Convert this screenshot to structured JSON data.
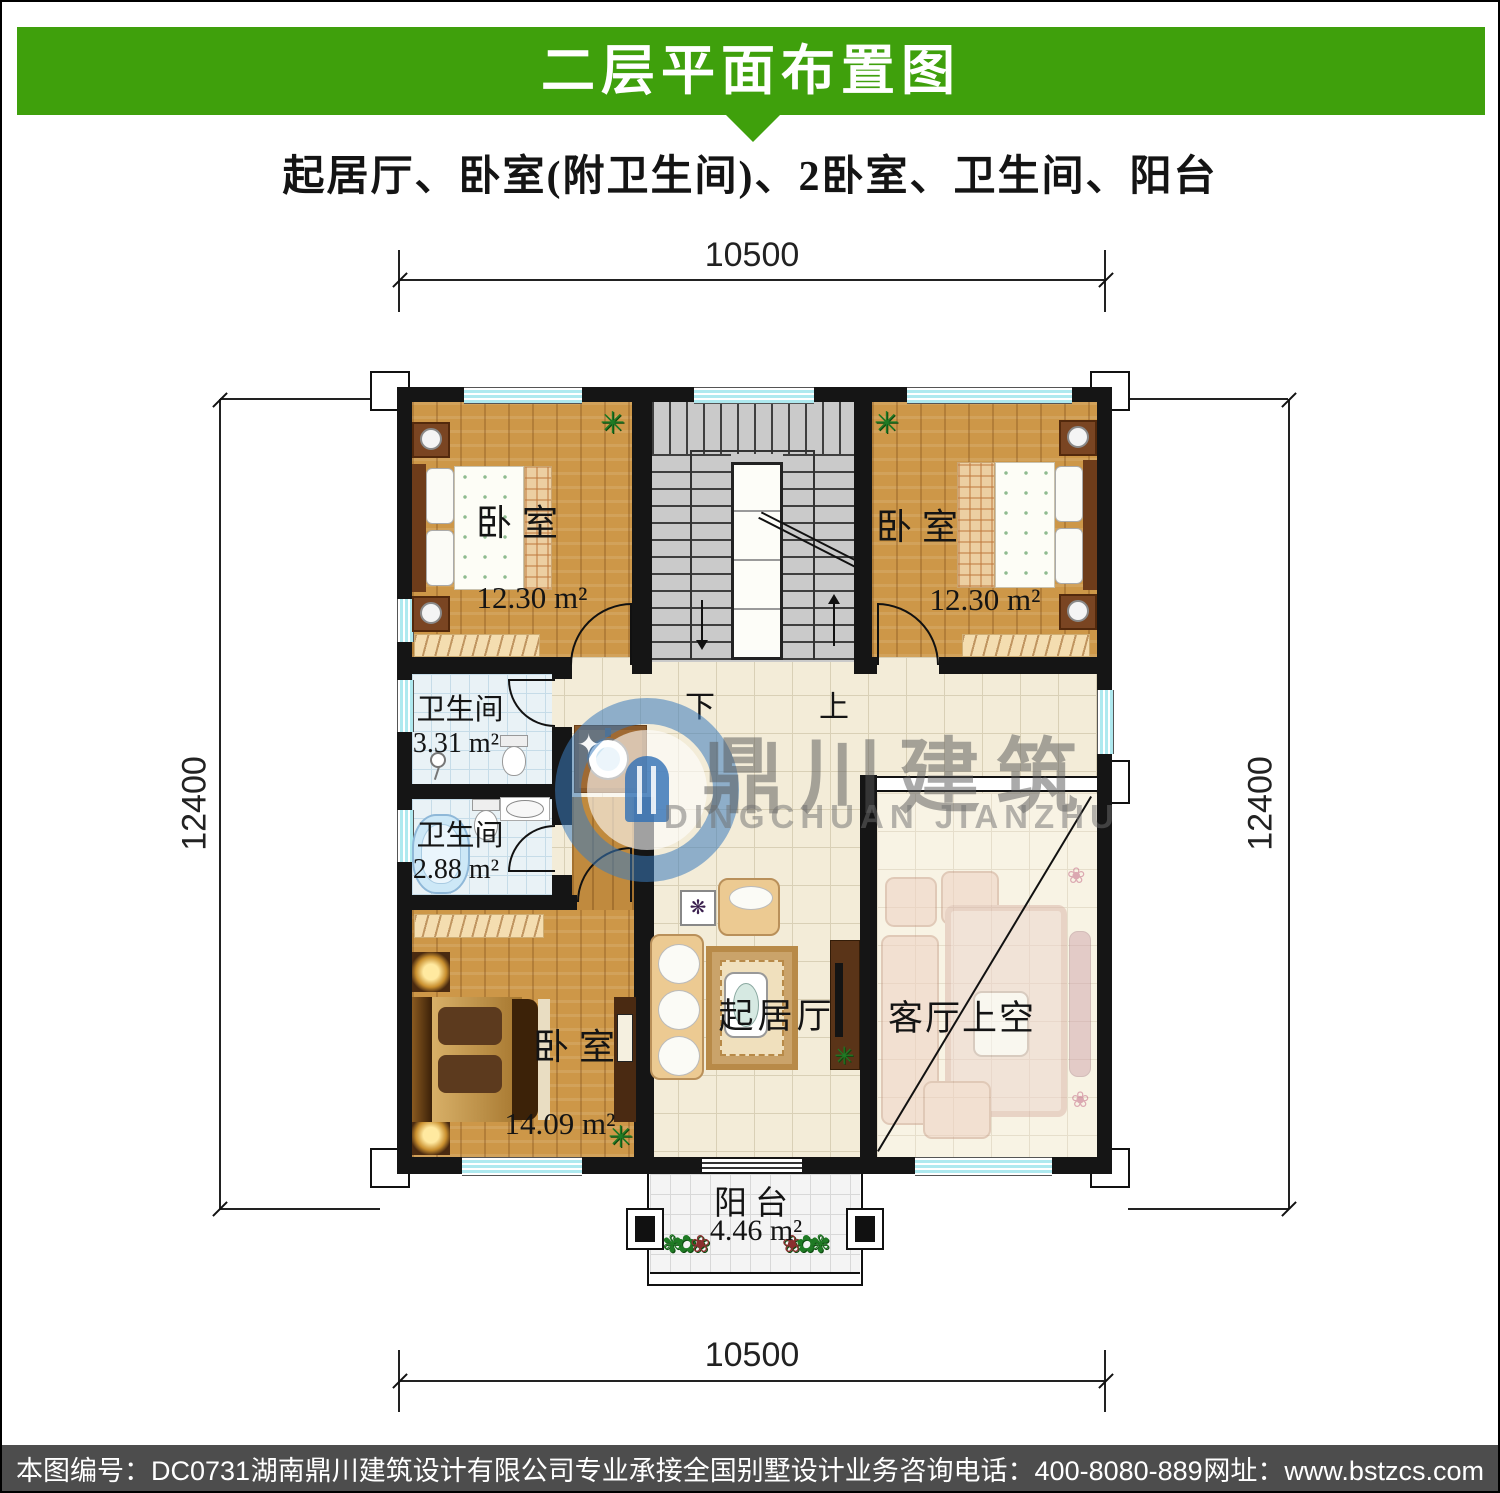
{
  "header": {
    "title": "二层平面布置图",
    "subtitle": "起居厅、卧室(附卫生间)、2卧室、卫生间、阳台",
    "banner_color": "#3fa00c"
  },
  "dimensions": {
    "top": "10500",
    "bottom": "10500",
    "left": "12400",
    "right": "12400"
  },
  "rooms": {
    "bedroom_tl": {
      "label": "卧室",
      "area": "12.30 m²"
    },
    "bedroom_tr": {
      "label": "卧室",
      "area": "12.30 m²"
    },
    "bath_1": {
      "label": "卫生间",
      "area": "3.31 m²"
    },
    "bath_2": {
      "label": "卫生间",
      "area": "2.88 m²"
    },
    "bedroom_bl": {
      "label": "卧室",
      "area": "14.09 m²"
    },
    "living": {
      "label": "起居厅"
    },
    "void": {
      "label": "客厅上空"
    },
    "balcony": {
      "label": "阳台",
      "area": "4.46 m²"
    }
  },
  "stairs": {
    "down_label": "下",
    "up_label": "上"
  },
  "watermark": {
    "name_cn": "鼎川建筑",
    "name_en": "DINGCHUAN JIANZHU"
  },
  "footer": {
    "items": [
      "本图编号：DC0731",
      "湖南鼎川建筑设计有限公司专业承接全国别墅设计业务",
      "咨询电话：400-8080-889",
      "网址：www.bstzcs.com"
    ]
  }
}
